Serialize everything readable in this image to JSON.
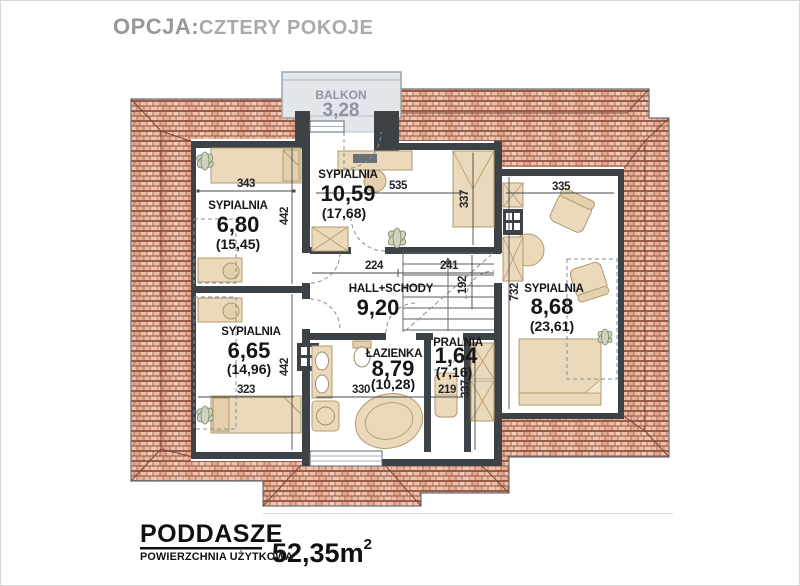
{
  "header": {
    "prefix": "OPCJA:",
    "title": "CZTERY POKOJE"
  },
  "balcony": {
    "name": "BALKON",
    "area": "3,28"
  },
  "rooms": [
    {
      "name": "SYPIALNIA",
      "area": "6,80",
      "total": "(15,45)"
    },
    {
      "name": "SYPIALNIA",
      "area": "10,59",
      "total": "(17,68)"
    },
    {
      "name": "SYPIALNIA",
      "area": "8,68",
      "total": "(23,61)"
    },
    {
      "name": "SYPIALNIA",
      "area": "6,65",
      "total": "(14,96)"
    },
    {
      "name": "HALL+SCHODY",
      "area": "9,20"
    },
    {
      "name": "ŁAZIENKA",
      "area": "8,79",
      "total": "(10,28)"
    },
    {
      "name": "PRALNIA",
      "area": "1,64",
      "total": "(7,16)"
    }
  ],
  "dimensions": {
    "s1_w": "343",
    "s1_h": "442",
    "s2_w": "535",
    "s2_d": "337",
    "s3_w": "335",
    "s3_h": "732",
    "hall_w1": "224",
    "hall_w2": "241",
    "stair_w": "192",
    "s4_w": "323",
    "s4_h": "442",
    "bath_w": "330",
    "laundry_w": "219",
    "laundry_h": "337"
  },
  "footer": {
    "title": "PODDASZE",
    "subtitle": "POWIERZCHNIA UŻYTKOWA",
    "area": "52,35m",
    "area_sup": "2"
  },
  "colors": {
    "roof": "#edbfa8",
    "roof_line": "#8f4f3c",
    "wall": "#3d4247",
    "furniture": "#ead9ba",
    "balcony_bg": "#e3e7ec",
    "balcony_text": "#8b95a0",
    "text": "#161616",
    "header_gray": "#989898"
  }
}
